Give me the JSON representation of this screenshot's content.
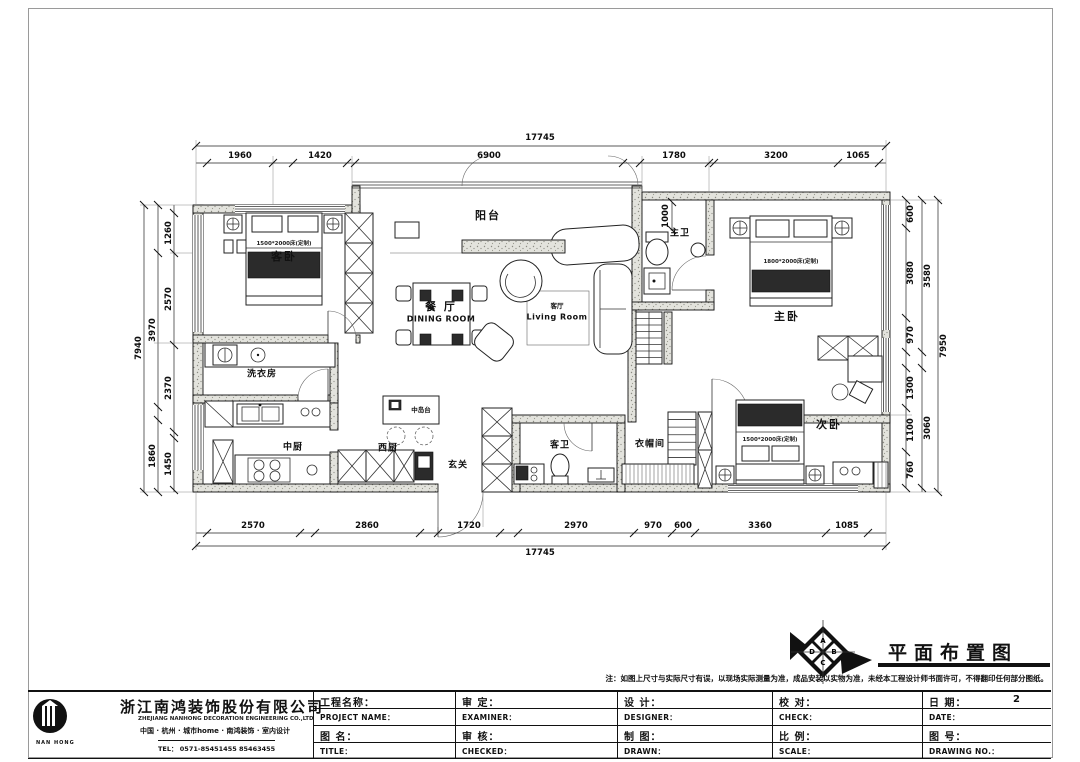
{
  "drawing": {
    "title": "平面布置图",
    "note": "注：如图上尺寸与实际尺寸有误，以现场实际测量为准，成品安装以实物为准，未经本工程设计师书面许可，不得翻印任何部分图纸。",
    "compass": {
      "letters": [
        "A",
        "B",
        "C",
        "D"
      ]
    }
  },
  "rooms": {
    "guest_bedroom": "客卧",
    "laundry": "洗衣房",
    "chinese_kitchen": "中厨",
    "western_kitchen": "西厨",
    "island": "中岛台",
    "foyer": "玄关",
    "dining_cn": "餐 厅",
    "dining_en": "DINING ROOM",
    "living_cn": "客厅",
    "living_en": "Living Room",
    "balcony": "阳台",
    "master_bath": "主卫",
    "master_bedroom": "主卧",
    "guest_bath": "客卫",
    "cloakroom": "衣帽间",
    "second_bedroom": "次卧",
    "bed_note_guest": "1500*2000床(定制)",
    "bed_note_master": "1800*2000床(定制)",
    "bed_note_second": "1500*2000床(定制)"
  },
  "dimensions": {
    "top_total": "17745",
    "top": [
      "1960",
      "1420",
      "6900",
      "1780",
      "3200",
      "1065"
    ],
    "bottom_total": "17745",
    "bottom": [
      "2570",
      "2860",
      "1720",
      "2970",
      "970",
      "600",
      "3360",
      "1085"
    ],
    "left_total": "7940",
    "left_mid": [
      "3970",
      "1860"
    ],
    "left_inner": [
      "1260",
      "2570",
      "2370",
      "1450"
    ],
    "right_total": "7950",
    "right_mid": [
      "3580",
      "3060"
    ],
    "right_inner": [
      "600",
      "3080",
      "970",
      "1300",
      "1100",
      "760"
    ],
    "inner_1000": "1000"
  },
  "title_block": {
    "company_cn": "浙江南鸿装饰股份有限公司",
    "company_en": "ZHEJIANG NANHONG DECORATION ENGINEERING CO.,LTD",
    "company_sub": "中国 · 杭州 · 城市home · 南鸿装饰 · 室内设计",
    "tel": "TEL： 0571-85451455  85463455",
    "logo_text": "NAN HONG",
    "project_name_cn": "工程名称：",
    "project_name_en": "PROJECT NAME：",
    "title_cn": "图 名：",
    "title_en": "TITLE：",
    "examiner_cn": "审 定：",
    "examiner_en": "EXAMINER：",
    "checked_cn": "审 核：",
    "checked_en": "CHECKED：",
    "designer_cn": "设 计：",
    "designer_en": "DESIGNER：",
    "drawn_cn": "制 图：",
    "drawn_en": "DRAWN：",
    "check_cn": "校 对：",
    "check_en": "CHECK：",
    "scale_cn": "比 例：",
    "scale_en": "SCALE：",
    "date_cn": "日 期：",
    "date_en": "DATE：",
    "date_value": "2",
    "drawing_no_cn": "图 号：",
    "drawing_no_en": "DRAWING NO.："
  }
}
